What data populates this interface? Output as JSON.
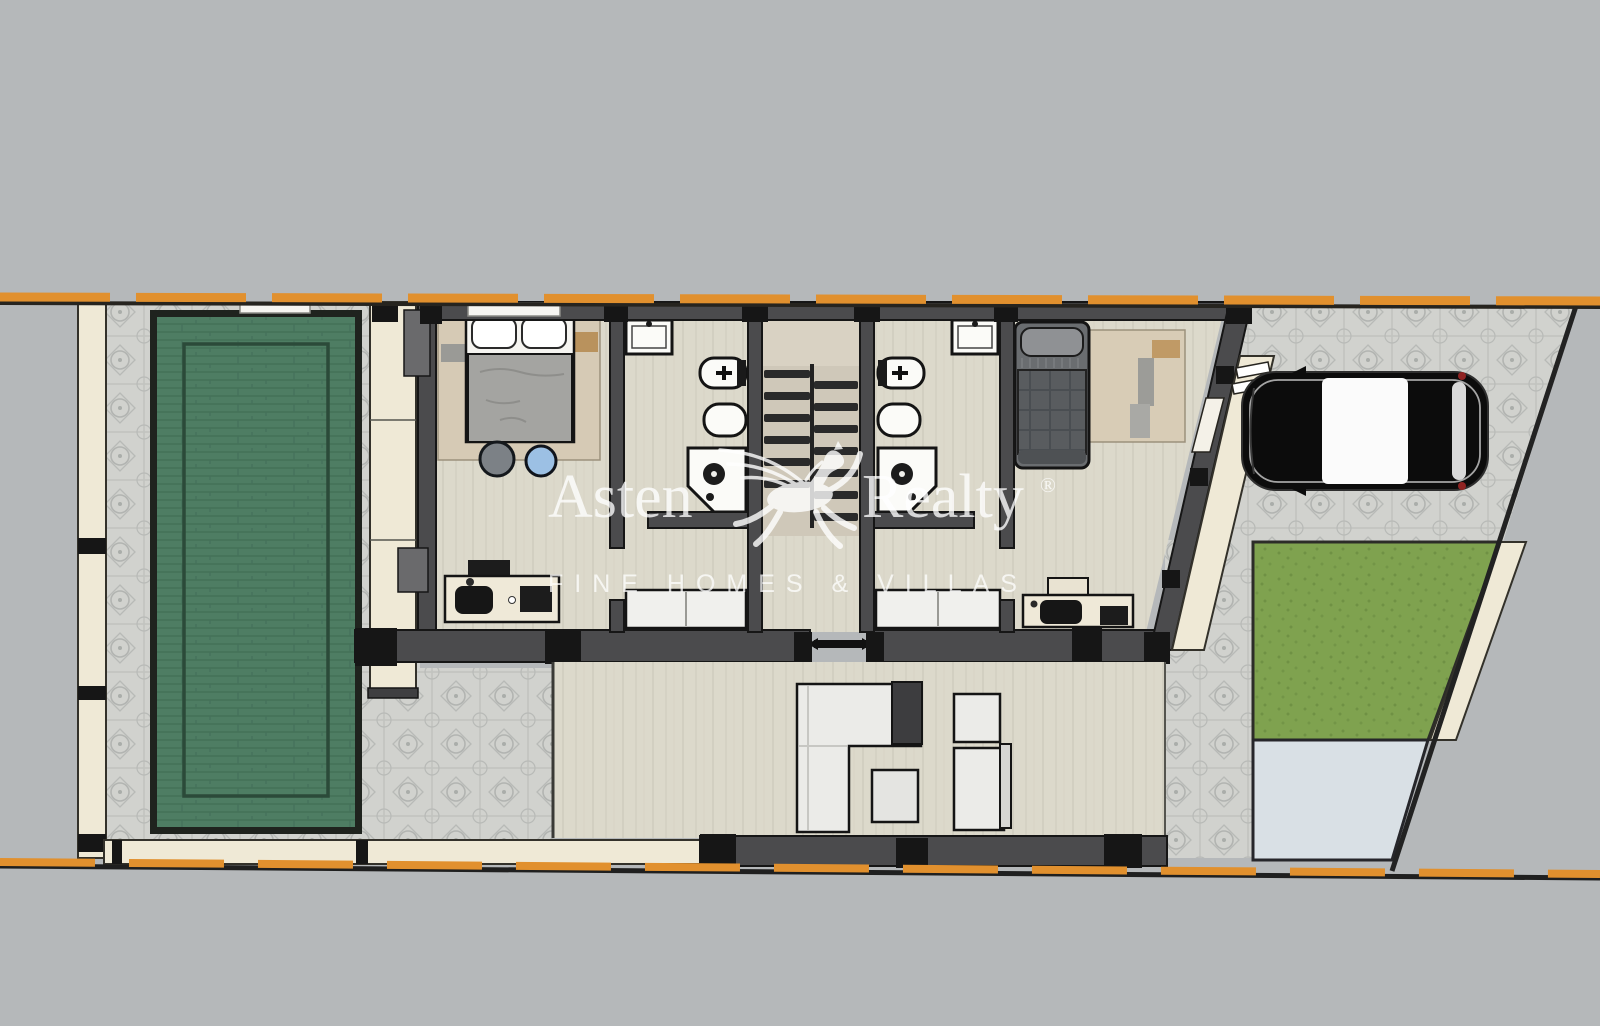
{
  "title": "Villa upper-floor plan render with pool, terrace, driveway and garden",
  "watermark": {
    "brand_left": "Asten",
    "brand_right": "Realty",
    "registered_mark": "®",
    "tagline": "FINE HOMES & VILLAS",
    "logo_icon": "pegasus-horse-icon",
    "color": "#ffffff"
  },
  "palette": {
    "background": "#b5b8ba",
    "boundary_orange": "#e1902e",
    "pool_green": "#4e7d63",
    "pool_border": "#1f231e",
    "lawn_green": "#7fa24f",
    "tile_gray": "#d1d2ce",
    "wood_floor": "#dcd9cb",
    "wall_gray": "#4b4b4d",
    "pillar_black": "#161616",
    "cream_wall": "#efe9d6",
    "concrete_pad": "#d9e0e5",
    "car_body": "#0c0c0c",
    "taillight_red": "#8f2322",
    "stool_gray": "#7c8186",
    "stool_blue": "#9cc0e4"
  },
  "plan_features": [
    "plot-boundary-dashed-lines",
    "swimming-pool",
    "tiled-patio",
    "walkway",
    "master-bedroom",
    "double-bed",
    "round-stools",
    "desk-with-chair",
    "bathroom-1",
    "bathroom-2",
    "wash-basin",
    "toilet",
    "bidet",
    "corner-shower",
    "staircase",
    "hallway-closets",
    "second-bedroom",
    "single-bed",
    "living-terrace",
    "l-shaped-sofa",
    "coffee-table",
    "chaise-lounge",
    "driveway",
    "parked-car",
    "lawn",
    "concrete-pad",
    "entry-steps"
  ]
}
